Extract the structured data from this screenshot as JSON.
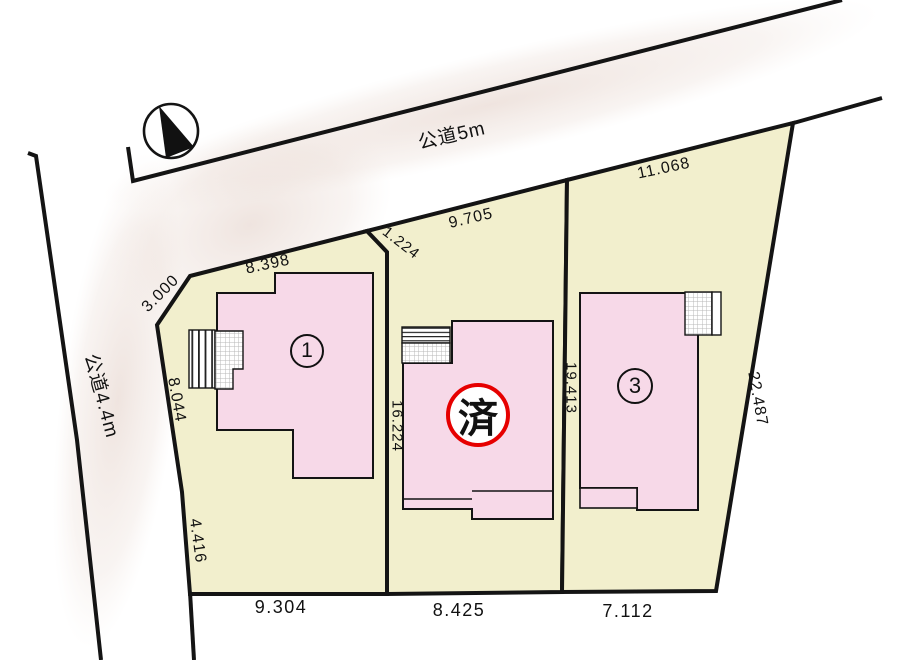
{
  "roads": {
    "top_label": "公道5m",
    "left_label": "公道4.4m"
  },
  "lots": {
    "lot1": {
      "number": "1"
    },
    "lot2": {
      "status": "済"
    },
    "lot3": {
      "number": "3"
    }
  },
  "dimensions": {
    "lot1_top": "8.398",
    "lot1_corner_cut": "3.000",
    "lot1_left_upper": "8.044",
    "lot1_left_lower": "4.416",
    "lot1_bottom": "9.304",
    "lot2_step": "1.224",
    "lot2_top": "9.705",
    "lot2_left": "16.224",
    "lot2_bottom": "8.425",
    "lot3_left": "19.413",
    "lot3_top": "11.068",
    "lot3_right": "22.487",
    "lot3_bottom": "7.112"
  },
  "colors": {
    "lot_fill": "#f2efcd",
    "building_fill": "#f7d9e8",
    "boundary": "#141414",
    "sold_red": "#e60000"
  }
}
